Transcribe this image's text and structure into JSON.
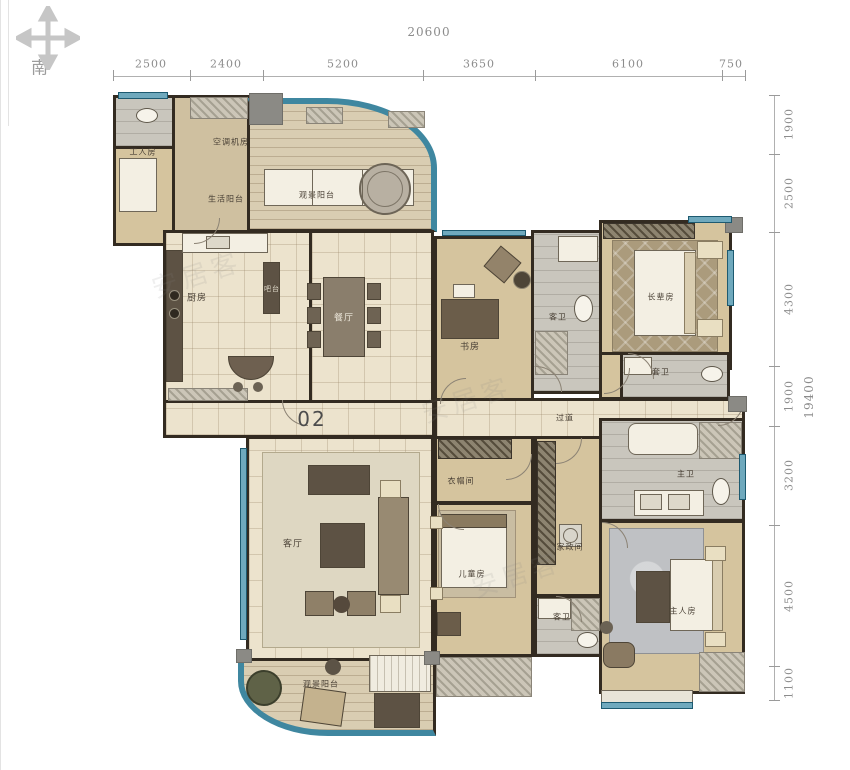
{
  "compass": {
    "south_label": "南"
  },
  "unit_label": "02",
  "watermark_text": "安居客",
  "dimensions": {
    "top": {
      "total": "20600",
      "segments": [
        "2500",
        "2400",
        "5200",
        "3650",
        "6100",
        "750"
      ]
    },
    "right": {
      "total": "19400",
      "segments": [
        "1900",
        "2500",
        "4300",
        "1900",
        "3200",
        "4500",
        "1100"
      ]
    }
  },
  "rooms": {
    "maid_room": "工人房",
    "ac_platform": "空调机房",
    "service_balcony": "生活阳台",
    "top_view_balcony": "观景阳台",
    "kitchen": "厨房",
    "bar_counter": "吧台",
    "dining_room": "餐厅",
    "study": "书房",
    "guest_bath": "客卫",
    "elder_bedroom": "长辈房",
    "ensuite_bath": "套卫",
    "hallway": "过道",
    "living_room": "客厅",
    "walkin_closet": "衣帽间",
    "kids_bedroom": "儿童房",
    "housekeeping_room": "家政间",
    "second_bath": "客卫",
    "master_bath": "主卫",
    "master_bedroom": "主人房",
    "view_balcony": "观景阳台"
  },
  "palette": {
    "wall": "#332b21",
    "window": "#6fa9bd",
    "windowBorder": "#1d5a70",
    "floorWood": "#d5c49e",
    "floorTile": "#ece3cd",
    "floorGray": "#c9c6bd",
    "dimText": "#8c8c8c"
  }
}
